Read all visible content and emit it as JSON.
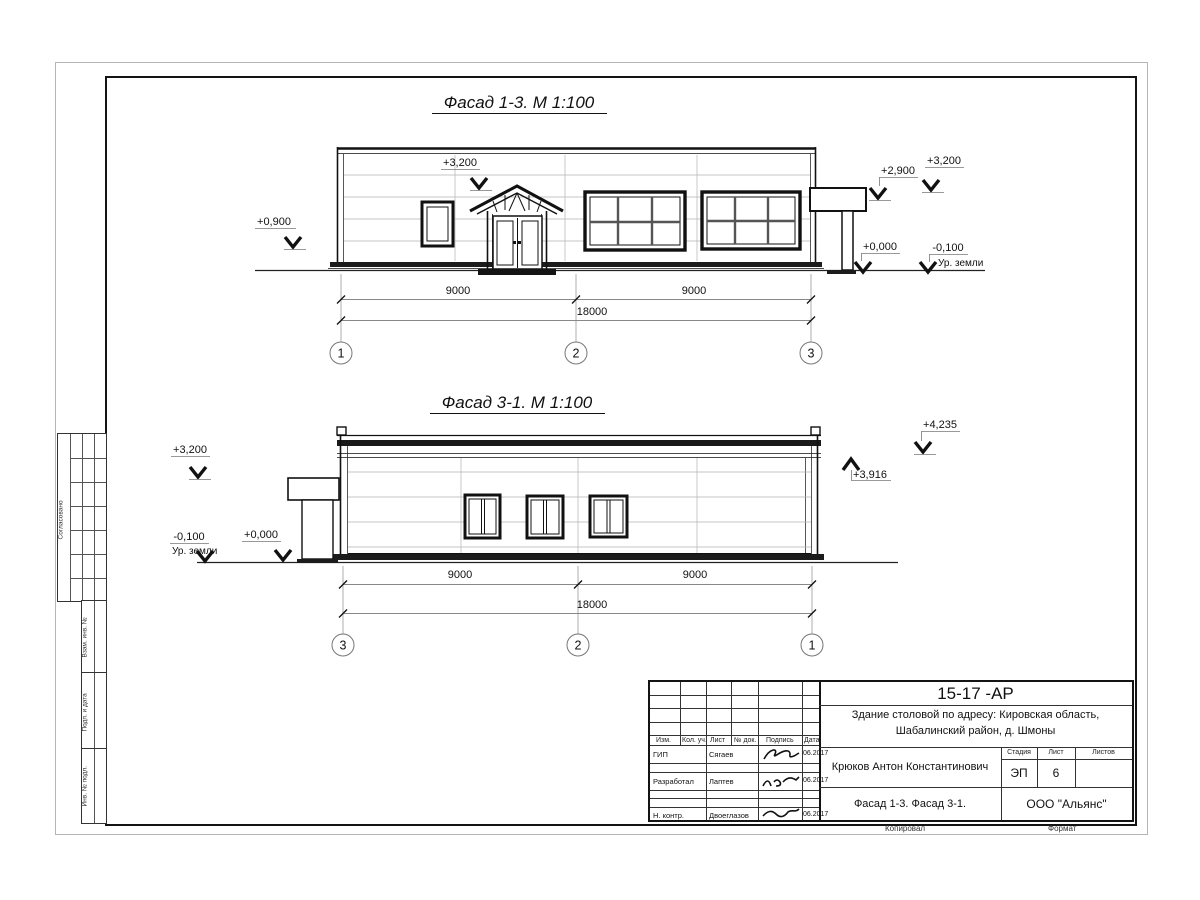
{
  "facade1": {
    "title": "Фасад 1-3. М 1:100",
    "dims": [
      "9000",
      "9000",
      "18000"
    ],
    "axes": [
      "1",
      "2",
      "3"
    ],
    "marks": {
      "left_top": "+3,200",
      "left": "+0,900",
      "right_1": "+2,900",
      "right_2": "+3,200",
      "zero": "+0,000",
      "minus": "-0,100",
      "ground": "Ур. земли"
    }
  },
  "facade2": {
    "title": "Фасад 3-1. М 1:100",
    "dims": [
      "9000",
      "9000",
      "18000"
    ],
    "axes": [
      "3",
      "2",
      "1"
    ],
    "marks": {
      "left_top": "+3,200",
      "minus": "-0,100",
      "ground": "Ур. земли",
      "zero": "+0,000",
      "top_right": "+4,235",
      "right": "+3,916"
    }
  },
  "stamp_side": {
    "agreed": "Согласовано",
    "vzam": "Взам. инв. №",
    "podp": "Подп. и дата",
    "inv": "Инв. № подл."
  },
  "titleblock": {
    "doc_number": "15-17 -АР",
    "project_line1": "Здание столовой по адресу: Кировская область,",
    "project_line2": "Шабалинский район, д. Шмоны",
    "header": {
      "izm": "Изм.",
      "kol": "Кол. уч.",
      "list": "Лист",
      "doc": "№ док.",
      "sign": "Подпись",
      "date": "Дата"
    },
    "rows": [
      {
        "role": "ГИП",
        "name": "Сягаев",
        "date": "06.2017"
      },
      {
        "role": "Разработал",
        "name": "Лаптев",
        "date": "06.2017"
      },
      {
        "role": "Н. контр.",
        "name": "Двоеглазов",
        "date": "06.2017"
      }
    ],
    "author": "Крюков Антон Константинович",
    "stage_label": "Стадия",
    "sheet_label": "Лист",
    "sheets_label": "Листов",
    "stage": "ЭП",
    "sheet_num": "6",
    "drawing_name": "Фасад 1-3. Фасад 3-1.",
    "company": "ООО \"Альянс\"",
    "copied": "Копировал",
    "format": "Формат"
  }
}
